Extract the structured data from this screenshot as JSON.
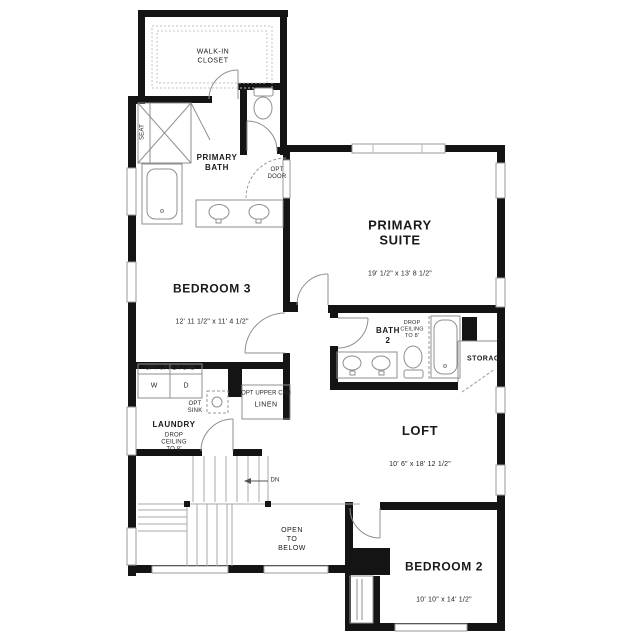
{
  "colors": {
    "wall": "#141414",
    "fixture_line": "#8f8f8f",
    "window_line": "#9a9a9a",
    "text": "#1a1a1a",
    "background": "#ffffff"
  },
  "rooms": {
    "walk_in_closet": {
      "name": "WALK-IN\nCLOSET"
    },
    "primary_bath": {
      "name": "PRIMARY\nBATH"
    },
    "primary_suite": {
      "name": "PRIMARY\nSUITE",
      "dims": "19' 1/2\" x 13' 8 1/2\""
    },
    "bedroom_3": {
      "name": "BEDROOM 3",
      "dims": "12' 11 1/2\" x 11' 4 1/2\""
    },
    "bath_2": {
      "name": "BATH\n2"
    },
    "storage": {
      "name": "STORAGE"
    },
    "laundry": {
      "name": "LAUNDRY"
    },
    "linen": {
      "name": "LINEN"
    },
    "loft": {
      "name": "LOFT",
      "dims": "10' 6\" x 18' 12 1/2\""
    },
    "open_to_below": {
      "name": "OPEN\nTO\nBELOW"
    },
    "bedroom_2": {
      "name": "BEDROOM 2",
      "dims": "10' 10\" x 14' 1/2\""
    }
  },
  "annotations": {
    "seat": "SEAT",
    "opt_door": "OPT\nDOOR",
    "opt_sink": "OPT\nSINK",
    "opt_upper_cab": "OPT UPPER CAB",
    "drop_ceiling": "DROP\nCEILING\nTO 8'",
    "washer": "W",
    "dryer": "D",
    "down": "DN"
  }
}
